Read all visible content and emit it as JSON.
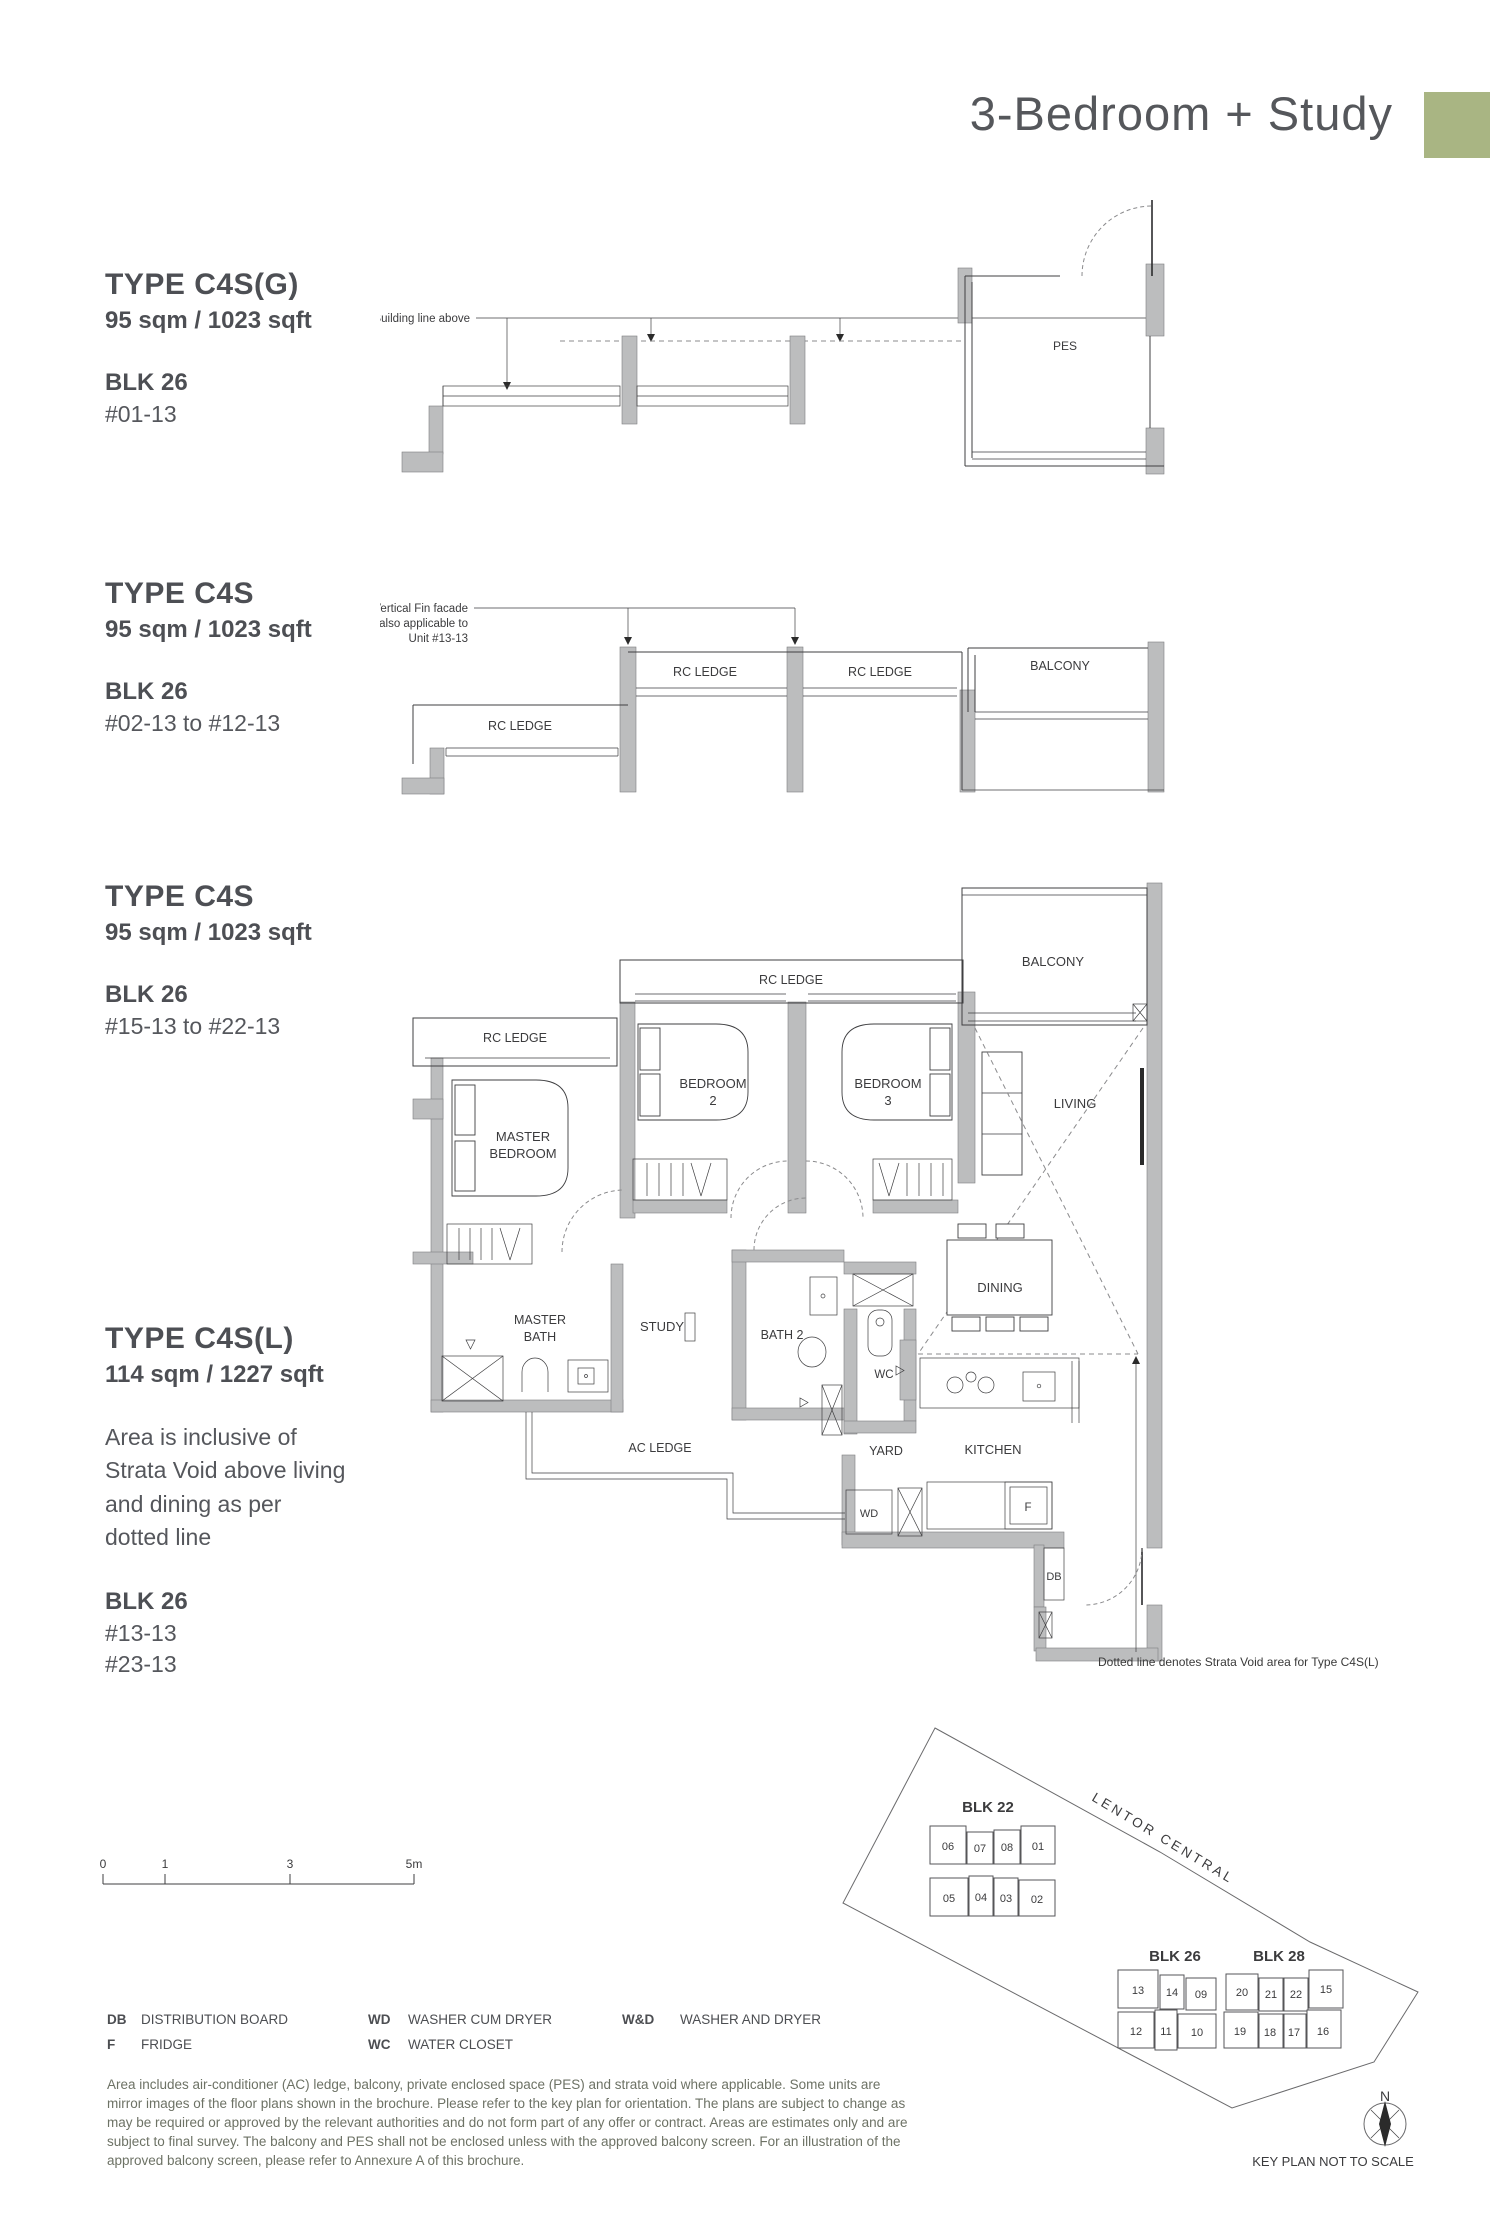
{
  "header": {
    "title": "3-Bedroom + Study",
    "accent_color": "#a9b583"
  },
  "sections": {
    "s1": {
      "type": "TYPE C4S(G)",
      "area": "95 sqm / 1023 sqft",
      "block": "BLK 26",
      "units": "#01-13"
    },
    "s2": {
      "type": "TYPE C4S",
      "area": "95 sqm / 1023 sqft",
      "block": "BLK 26",
      "units": "#02-13 to #12-13"
    },
    "s3": {
      "type": "TYPE C4S",
      "area": "95 sqm / 1023 sqft",
      "block": "BLK 26",
      "units": "#15-13 to #22-13"
    },
    "s4": {
      "type": "TYPE C4S(L)",
      "area": "114 sqm / 1227 sqft",
      "note": "Area is inclusive of Strata Void above living and dining as per dotted line",
      "block": "BLK 26",
      "units1": "#13-13",
      "units2": "#23-13"
    }
  },
  "plan_labels": {
    "building_line": "Building line above",
    "vertical_fin1": "Vertical Fin facade",
    "vertical_fin2": "also applicable to",
    "vertical_fin3": "Unit #13-13",
    "pes": "PES",
    "rc_ledge": "RC LEDGE",
    "balcony": "BALCONY",
    "word_master": "MASTER",
    "word_bedroom": "BEDROOM",
    "word_bath": "BATH",
    "no2": "2",
    "no3": "3",
    "bath2": "BATH 2",
    "study": "STUDY",
    "living": "LIVING",
    "dining": "DINING",
    "kitchen": "KITCHEN",
    "yard": "YARD",
    "ac_ledge": "AC LEDGE",
    "wc": "WC",
    "wd": "WD",
    "f": "F",
    "db": "DB"
  },
  "strata_note": "Dotted line denotes Strata Void area for Type C4S(L)",
  "scalebar": {
    "t0": "0",
    "t1": "1",
    "t3": "3",
    "t5": "5m"
  },
  "legend": {
    "items": [
      {
        "abbr": "DB",
        "label": "DISTRIBUTION BOARD"
      },
      {
        "abbr": "F",
        "label": "FRIDGE"
      },
      {
        "abbr": "WD",
        "label": "WASHER CUM DRYER"
      },
      {
        "abbr": "WC",
        "label": "WATER CLOSET"
      },
      {
        "abbr": "W&D",
        "label": "WASHER AND DRYER"
      }
    ]
  },
  "disclaimer": "Area includes air-conditioner (AC) ledge, balcony, private enclosed space (PES) and strata void where applicable. Some units are mirror images of the floor plans shown in the brochure. Please refer to the key plan for orientation. The plans are subject to change as may be required or approved by the relevant authorities and do not form part of any offer or contract. Areas are estimates only and are subject to final survey. The balcony and PES shall not be enclosed unless with the approved balcony screen. For an illustration of the approved balcony screen, please refer to Annexure A of this brochure.",
  "keyplan": {
    "blk22": "BLK 22",
    "blk26": "BLK 26",
    "blk28": "BLK 28",
    "road": "LENTOR CENTRAL",
    "north": "N",
    "note": "KEY PLAN NOT TO SCALE",
    "highlight_color": "#a9b583",
    "highlighted_unit": "13",
    "blk22_row1": [
      "06",
      "07",
      "08",
      "01"
    ],
    "blk22_row2": [
      "05",
      "04",
      "03",
      "02"
    ],
    "blk26_row1": [
      "13",
      "14",
      "09"
    ],
    "blk26_row2": [
      "12",
      "11",
      "10"
    ],
    "blk28_row1": [
      "20",
      "21",
      "22",
      "15"
    ],
    "blk28_row2": [
      "19",
      "18",
      "17",
      "16"
    ]
  }
}
